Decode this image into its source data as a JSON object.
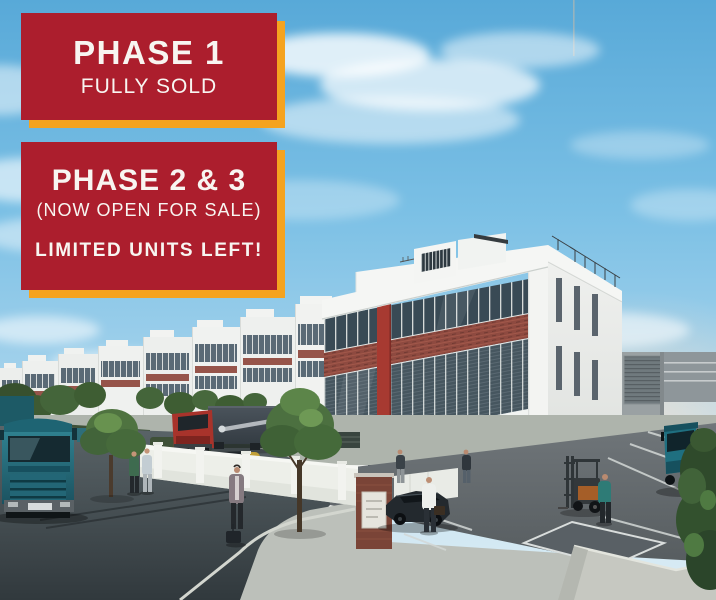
{
  "banners": {
    "phase1": {
      "title": "PHASE 1",
      "status": "FULLY SOLD"
    },
    "phase2_3": {
      "title": "PHASE 2 & 3",
      "status": "(NOW OPEN FOR SALE)",
      "note": "LIMITED UNITS LEFT!"
    }
  },
  "colors": {
    "banner_red": "#AC1E2D",
    "banner_yellow": "#F5A31F",
    "banner_text": "#F8F5F1",
    "sky_top": "#58A9D8",
    "sky_horizon": "#DCEDF5",
    "brick_accent": "#8E4A40",
    "building_white": "#F4F5F3",
    "glass": "#3E4F5A",
    "asphalt": "#4A545A"
  },
  "scene": {
    "description": "3D architectural render of an industrial business park: rows of white warehouse units with glass curtain walls and red-brick accent bands, street with trucks, cars, a forklift, pedestrians and trees under a blue sky with soft clouds"
  }
}
